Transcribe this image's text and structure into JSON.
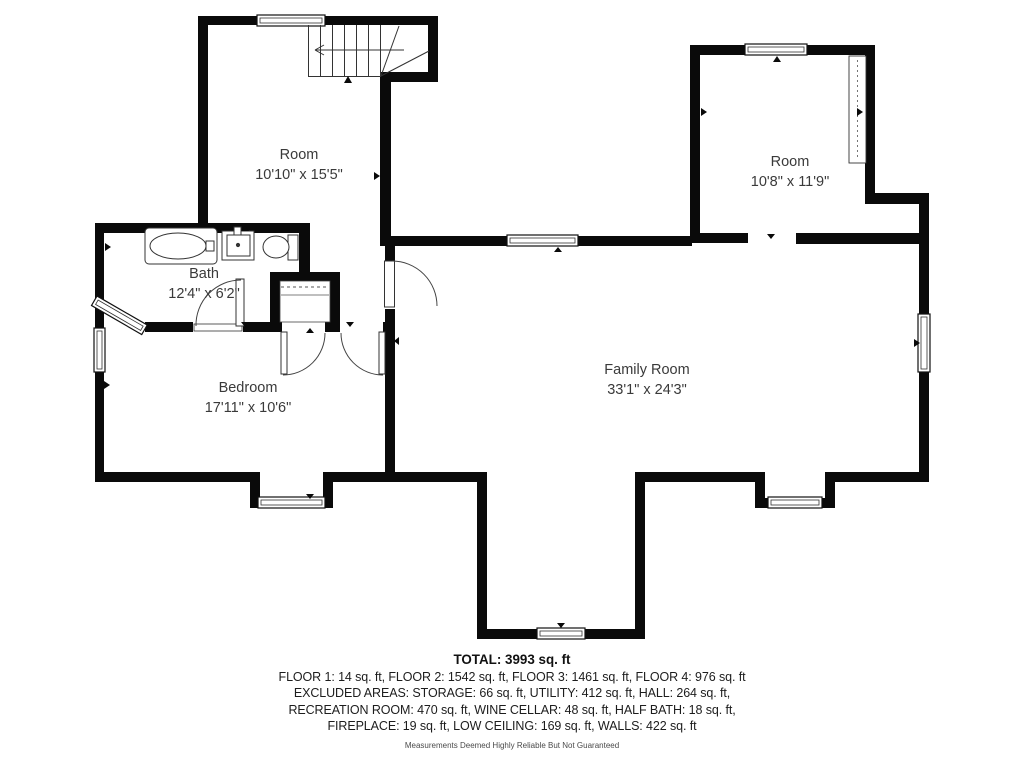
{
  "floorplan": {
    "rooms": [
      {
        "name": "Room",
        "dimensions": "10'10\" x 15'5\""
      },
      {
        "name": "Room",
        "dimensions": "10'8\" x 11'9\""
      },
      {
        "name": "Bath",
        "dimensions": "12'4\" x 6'2\""
      },
      {
        "name": "Bedroom",
        "dimensions": "17'11\" x 10'6\""
      },
      {
        "name": "Family Room",
        "dimensions": "33'1\" x 24'3\""
      }
    ],
    "features": [
      "stairs",
      "bathtub",
      "sink",
      "toilet",
      "closet",
      "windows",
      "door-swings"
    ]
  },
  "summary": {
    "total": "TOTAL: 3993 sq. ft",
    "lines": [
      "FLOOR 1: 14 sq. ft, FLOOR 2: 1542 sq. ft, FLOOR 3: 1461 sq. ft, FLOOR 4: 976 sq. ft",
      "EXCLUDED AREAS: STORAGE: 66 sq. ft, UTILITY: 412 sq. ft, HALL: 264 sq. ft,",
      "RECREATION ROOM: 470 sq. ft, WINE CELLAR: 48 sq. ft, HALF BATH: 18 sq. ft,",
      "FIREPLACE: 19 sq. ft, LOW CEILING: 169 sq. ft, WALLS: 422 sq. ft"
    ],
    "disclaimer": "Measurements Deemed Highly Reliable But Not Guaranteed"
  },
  "colors": {
    "wall": "#0a0a0a",
    "label_text": "#3a3a3a",
    "summary_text": "#1d1d1d",
    "disclaimer_text": "#4a4a4a",
    "background": "#ffffff"
  }
}
